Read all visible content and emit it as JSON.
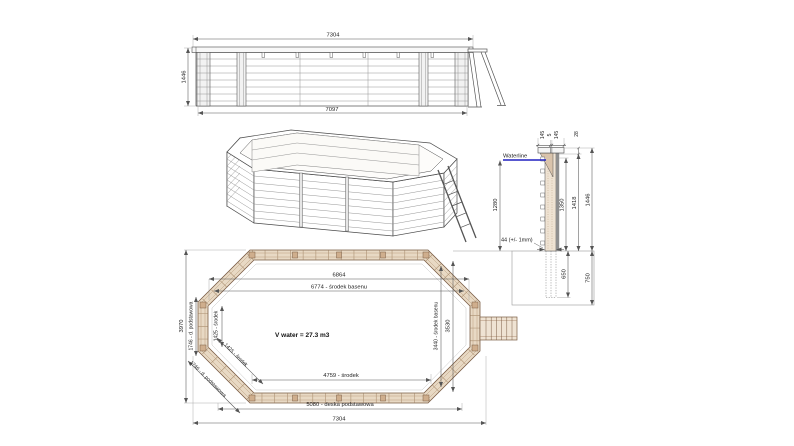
{
  "colors": {
    "waterline": "#2020c0",
    "wood_band": "#e8d9c4",
    "wood_post": "#cfae8d",
    "drawing_line": "#4a4a4a",
    "dim_line": "#555555"
  },
  "elevation": {
    "dim_top": "7304",
    "dim_bottom": "7097",
    "dim_height": "1446"
  },
  "cross_section": {
    "dim_cap_left": "145",
    "dim_cap_gap": "5",
    "dim_cap_right": "145",
    "dim_cap_to_water": "28",
    "waterline_label": "Waterline",
    "dim_water_depth": "1280",
    "dim_inner_height": "1350",
    "dim_wall_height": "1418",
    "dim_total_height": "1446",
    "note_plank": "44 (+/- 1mm)",
    "dim_buried_depth": "650",
    "dim_foundation_depth": "750"
  },
  "plan": {
    "dim_inner_length": "6864",
    "dim_center_length": "6774 - środek basenu",
    "volume_label": "V water = 27.3 m3",
    "dim_inner_width": "3530",
    "dim_center_width": "3440 - środek basenu",
    "dim_outer_width": "3970",
    "dim_end_board": "1746 - d. podstawowa",
    "dim_end_center": "1425 - środek",
    "dim_diag_center": "1425 - środek",
    "dim_diag_board": "1746 - d. podstawowa",
    "dim_bottom_center": "4759 - środek",
    "dim_base_board": "5080 - deska podstawowa",
    "dim_outer_length": "7304"
  }
}
